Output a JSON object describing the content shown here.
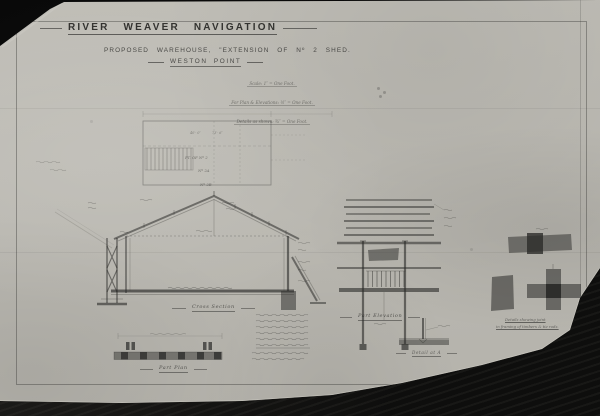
{
  "colors": {
    "background": "#070707",
    "paper": "#bbb9b2",
    "ink": "#2e2e2c"
  },
  "header": {
    "title": "RIVER WEAVER NAVIGATION",
    "subtitle": "PROPOSED WAREHOUSE, \"EXTENSION OF Nº 2 SHED.",
    "location": "WESTON POINT",
    "scale_line1": "Scale: 1″ = One Foot.",
    "scale_line2": "For Plan & Elevations: ½″ = One Foot.",
    "scale_line3": "Details as shown: ¾″ = One Foot."
  },
  "plan_view": {
    "dim_left": "40′· 0″",
    "dim_right": "73′· 6″",
    "label_1": "PT. OF Nº 2",
    "label_2": "Nº 2A",
    "label_3": "Nº 2B"
  },
  "captions": {
    "cross_section": "Cross Section",
    "part_elevation": "Part Elevation",
    "detail_a": "Detail at A",
    "joint_line1": "Details showing joint",
    "joint_line2": "in framing of timbers & tie rods.",
    "part_plan": "Part Plan"
  }
}
